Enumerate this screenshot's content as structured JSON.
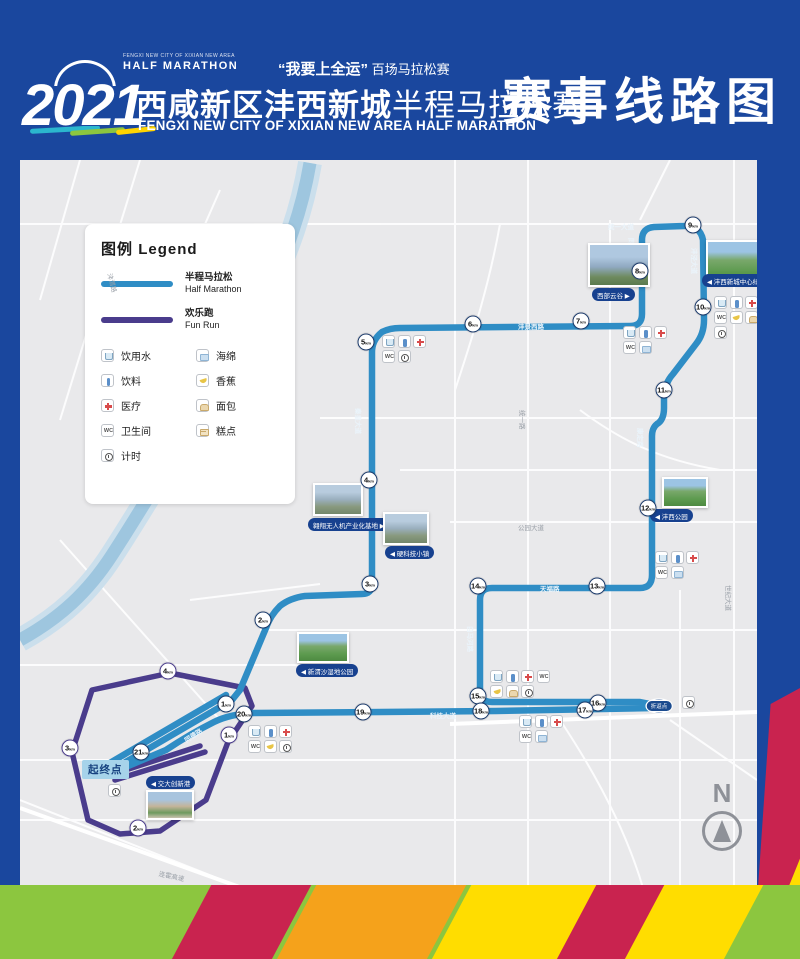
{
  "header": {
    "year": "2021",
    "logo_small_top": "FENGXI NEW CITY OF XIXIAN NEW AREA",
    "logo_small_bottom": "HALF MARATHON",
    "slogan_bold": "“我要上全运”",
    "slogan_rest": " 百场马拉松赛",
    "title_cn_bold": "西咸新区沣西新城",
    "title_cn_light": "半程马拉松赛",
    "title_en": "FENGXI NEW CITY OF XIXIAN NEW AREA HALF MARATHON",
    "page_title": "赛事线路图"
  },
  "legend": {
    "title_cn": "图例",
    "title_en": "Legend",
    "routes": [
      {
        "label_cn": "半程马拉松",
        "label_en": "Half Marathon",
        "color": "#2F8DC5"
      },
      {
        "label_cn": "欢乐跑",
        "label_en": "Fun Run",
        "color": "#4A3C8C"
      }
    ],
    "facilities": [
      {
        "id": "water",
        "label": "饮用水"
      },
      {
        "id": "drink",
        "label": "饮料"
      },
      {
        "id": "medical",
        "label": "医疗"
      },
      {
        "id": "toilet",
        "label": "卫生间"
      },
      {
        "id": "timing",
        "label": "计时"
      },
      {
        "id": "sponge",
        "label": "海绵"
      },
      {
        "id": "banana",
        "label": "香蕉"
      },
      {
        "id": "bread",
        "label": "面包"
      },
      {
        "id": "cake",
        "label": "糕点"
      }
    ]
  },
  "map": {
    "colors": {
      "half_route": "#2F8DC5",
      "fun_route": "#4A3C8C",
      "river": "#9EC6DF",
      "bg": "#E9E9EB"
    },
    "start_label": "起终点",
    "turnaround_label": "折返点",
    "north_label": "N",
    "unit": "km",
    "km_markers_half": [
      {
        "km": 1,
        "x": 206,
        "y": 544
      },
      {
        "km": 2,
        "x": 243,
        "y": 460
      },
      {
        "km": 3,
        "x": 350,
        "y": 424
      },
      {
        "km": 4,
        "x": 349,
        "y": 320
      },
      {
        "km": 5,
        "x": 346,
        "y": 182
      },
      {
        "km": 6,
        "x": 453,
        "y": 164
      },
      {
        "km": 7,
        "x": 561,
        "y": 161
      },
      {
        "km": 8,
        "x": 620,
        "y": 111
      },
      {
        "km": 9,
        "x": 673,
        "y": 65
      },
      {
        "km": 10,
        "x": 683,
        "y": 147
      },
      {
        "km": 11,
        "x": 644,
        "y": 230
      },
      {
        "km": 12,
        "x": 628,
        "y": 348
      },
      {
        "km": 13,
        "x": 577,
        "y": 426
      },
      {
        "km": 14,
        "x": 458,
        "y": 426
      },
      {
        "km": 15,
        "x": 458,
        "y": 536
      },
      {
        "km": 16,
        "x": 578,
        "y": 543
      },
      {
        "km": 17,
        "x": 565,
        "y": 550
      },
      {
        "km": 18,
        "x": 461,
        "y": 551
      },
      {
        "km": 19,
        "x": 343,
        "y": 552
      },
      {
        "km": 20,
        "x": 224,
        "y": 554
      },
      {
        "km": 21,
        "x": 121,
        "y": 592
      }
    ],
    "km_markers_fun": [
      {
        "km": 1,
        "x": 209,
        "y": 575
      },
      {
        "km": 2,
        "x": 118,
        "y": 668
      },
      {
        "km": 3,
        "x": 50,
        "y": 588
      },
      {
        "km": 4,
        "x": 148,
        "y": 511
      }
    ],
    "landmarks": [
      {
        "label": "翱翔无人机产业化基地",
        "arrow": "right",
        "photo": "aerial",
        "px": 293,
        "py": 323,
        "pw": 50,
        "ph": 33,
        "lx": 288,
        "ly": 358
      },
      {
        "label": "硬科技小镇",
        "arrow": "left",
        "photo": "aerial",
        "px": 363,
        "py": 352,
        "pw": 46,
        "ph": 33,
        "lx": 365,
        "ly": 386
      },
      {
        "label": "西部云谷",
        "arrow": "right",
        "photo": "city",
        "px": 568,
        "py": 83,
        "pw": 62,
        "ph": 44,
        "lx": 572,
        "ly": 128
      },
      {
        "label": "沣西新城中心绿廊",
        "arrow": "left",
        "photo": "park",
        "px": 686,
        "py": 80,
        "pw": 62,
        "ph": 44,
        "lx": 682,
        "ly": 114
      },
      {
        "label": "沣西公园",
        "arrow": "left",
        "photo": "park",
        "px": 642,
        "py": 317,
        "pw": 46,
        "ph": 31,
        "lx": 630,
        "ly": 349
      },
      {
        "label": "新渭沙湿地公园",
        "arrow": "left",
        "photo": "park",
        "px": 277,
        "py": 472,
        "pw": 52,
        "ph": 31,
        "lx": 276,
        "ly": 504
      },
      {
        "label": "交大创新港",
        "arrow": "left",
        "photo": "campus",
        "px": 126,
        "py": 630,
        "pw": 48,
        "ph": 30,
        "lx": 126,
        "ly": 616
      }
    ],
    "roads": [
      {
        "text": "秦皇大道",
        "x": 344,
        "y": 248,
        "rot": 90,
        "onroute": true
      },
      {
        "text": "沣景西路",
        "x": 498,
        "y": 161,
        "rot": 0,
        "onroute": true
      },
      {
        "text": "统一大道",
        "x": 588,
        "y": 61,
        "rot": 0,
        "onroute": true
      },
      {
        "text": "同文路",
        "x": 617,
        "y": 78,
        "rot": 90,
        "onroute": true
      },
      {
        "text": "沣泾大道",
        "x": 680,
        "y": 88,
        "rot": 90,
        "onroute": true
      },
      {
        "text": "康定路",
        "x": 626,
        "y": 268,
        "rot": 90,
        "onroute": true
      },
      {
        "text": "天福路",
        "x": 520,
        "y": 423,
        "rot": 0,
        "onroute": true
      },
      {
        "text": "白马河路",
        "x": 456,
        "y": 466,
        "rot": 90,
        "onroute": true
      },
      {
        "text": "科技大道",
        "x": 410,
        "y": 550,
        "rot": 0,
        "onroute": true
      },
      {
        "text": "同德路",
        "x": 162,
        "y": 576,
        "rot": -33,
        "onroute": true
      },
      {
        "text": "统一路",
        "x": 508,
        "y": 250,
        "rot": 90,
        "onroute": false
      },
      {
        "text": "世纪大道",
        "x": 714,
        "y": 425,
        "rot": 90,
        "onroute": false
      },
      {
        "text": "公园大道",
        "x": 498,
        "y": 362,
        "rot": 0,
        "onroute": false
      },
      {
        "text": "沣渭路",
        "x": 95,
        "y": 112,
        "rot": 75,
        "onroute": false
      },
      {
        "text": "连霍高速",
        "x": 140,
        "y": 708,
        "rot": 12,
        "onroute": false
      }
    ],
    "facility_clusters": [
      {
        "x": 362,
        "y": 175,
        "rows": [
          [
            "water",
            "drink",
            "medical"
          ],
          [
            "toilet",
            "timing"
          ]
        ]
      },
      {
        "x": 603,
        "y": 166,
        "rows": [
          [
            "water",
            "drink",
            "medical"
          ],
          [
            "toilet",
            "sponge"
          ]
        ]
      },
      {
        "x": 694,
        "y": 136,
        "rows": [
          [
            "water",
            "drink",
            "medical"
          ],
          [
            "toilet",
            "banana",
            "bread"
          ],
          [
            "timing"
          ]
        ]
      },
      {
        "x": 635,
        "y": 391,
        "rows": [
          [
            "water",
            "drink",
            "medical"
          ],
          [
            "toilet",
            "sponge"
          ]
        ]
      },
      {
        "x": 470,
        "y": 510,
        "rows": [
          [
            "water",
            "drink",
            "medical",
            "toilet"
          ],
          [
            "banana",
            "bread",
            "timing"
          ]
        ]
      },
      {
        "x": 499,
        "y": 555,
        "rows": [
          [
            "water",
            "drink",
            "medical"
          ],
          [
            "toilet",
            "sponge"
          ]
        ]
      },
      {
        "x": 228,
        "y": 565,
        "rows": [
          [
            "water",
            "drink",
            "medical"
          ],
          [
            "toilet",
            "banana",
            "timing"
          ]
        ]
      },
      {
        "x": 662,
        "y": 536,
        "rows": [
          [
            "timing"
          ]
        ]
      },
      {
        "x": 88,
        "y": 624,
        "rows": [
          [
            "timing"
          ]
        ]
      }
    ]
  }
}
